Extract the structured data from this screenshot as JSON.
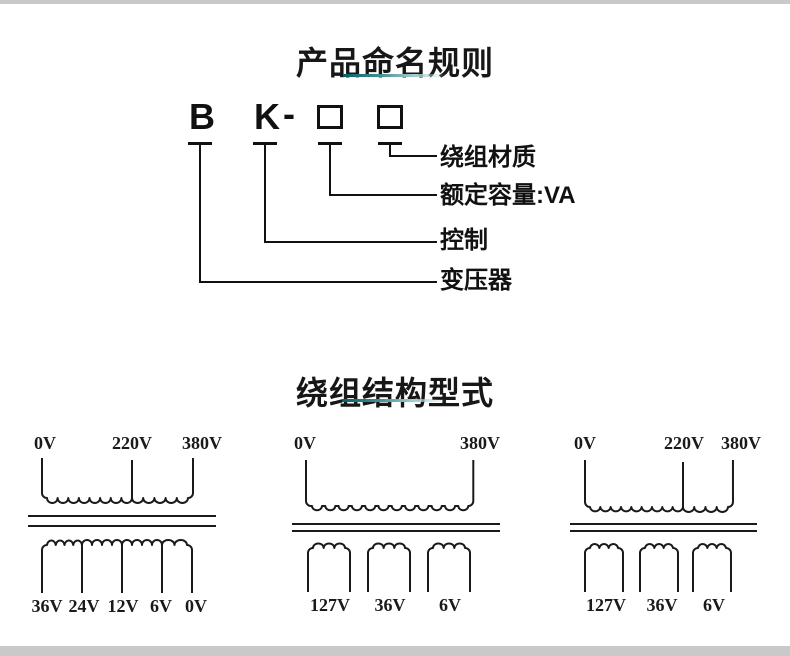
{
  "page": {
    "background": "#ffffff",
    "top_bar_color": "#c9c9c9",
    "bottom_bar_color": "#c9c9c9",
    "line_color": "#1a1a1a",
    "accent_teal": "#075f63"
  },
  "naming_section": {
    "title": "产品命名规则",
    "code": {
      "letter_b": "B",
      "letter_k": "K",
      "separator": "-"
    },
    "callouts": [
      {
        "label": "绕组材质"
      },
      {
        "label": "额定容量:VA"
      },
      {
        "label": "控制"
      },
      {
        "label": "变压器"
      }
    ]
  },
  "winding_section": {
    "title": "绕组结构型式",
    "diagrams": [
      {
        "primary_taps": [
          "0V",
          "220V",
          "380V"
        ],
        "secondary_taps": [
          "36V",
          "24V",
          "12V",
          "6V",
          "0V"
        ]
      },
      {
        "primary_taps": [
          "0V",
          "380V"
        ],
        "secondary_windings": [
          "127V",
          "36V",
          "6V"
        ]
      },
      {
        "primary_taps": [
          "0V",
          "220V",
          "380V"
        ],
        "secondary_windings": [
          "127V",
          "36V",
          "6V"
        ]
      }
    ]
  }
}
